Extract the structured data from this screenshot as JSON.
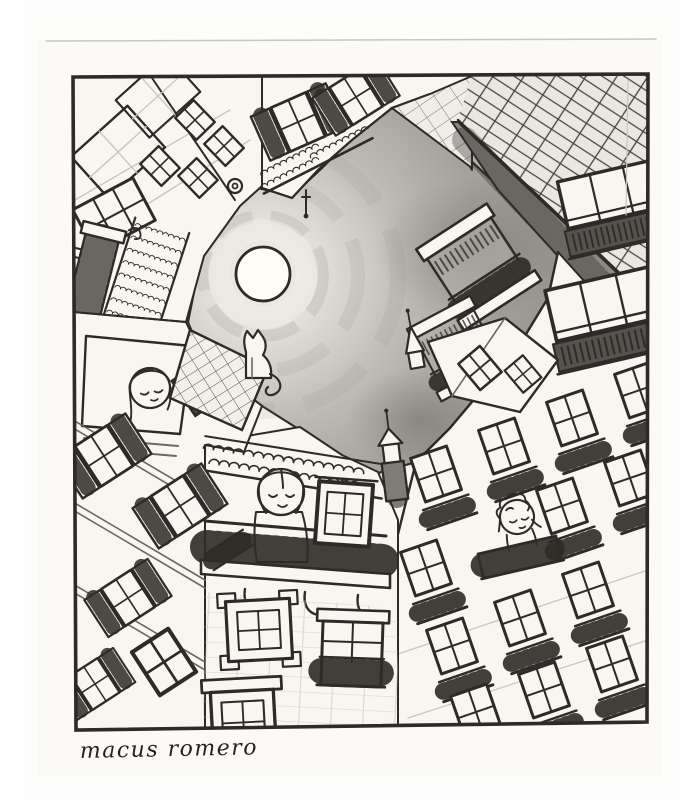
{
  "page": {
    "background": "#fefefe"
  },
  "artwork": {
    "type": "pencil-drawing",
    "description": "Worm's-eye pencil drawing looking straight up from a narrow courtyard: old shuttered buildings lean inward around a patch of shaded night sky with a full moon; a cat sits silhouetted on a rooftop, and three figures gaze up from a window and two balconies.",
    "signature": "macus romero",
    "colors": {
      "paper": "#f7f6f1",
      "ink": "#2d2b27",
      "ink_soft": "#6b6863",
      "faint": "#c9c6c0",
      "sky_center": "#f0eee9",
      "sky_edge": "#96938d",
      "roof_shade": "#8b8883",
      "foliage": "#56534e",
      "shutter_dark": "#4a4743",
      "moon": "#fdfcf7"
    },
    "elements": {
      "moon": "full-moon",
      "cat": "cat-silhouette-on-roof",
      "figures": [
        "figure-at-left-window",
        "figure-on-center-balcony",
        "figure-on-right-balcony"
      ]
    }
  }
}
